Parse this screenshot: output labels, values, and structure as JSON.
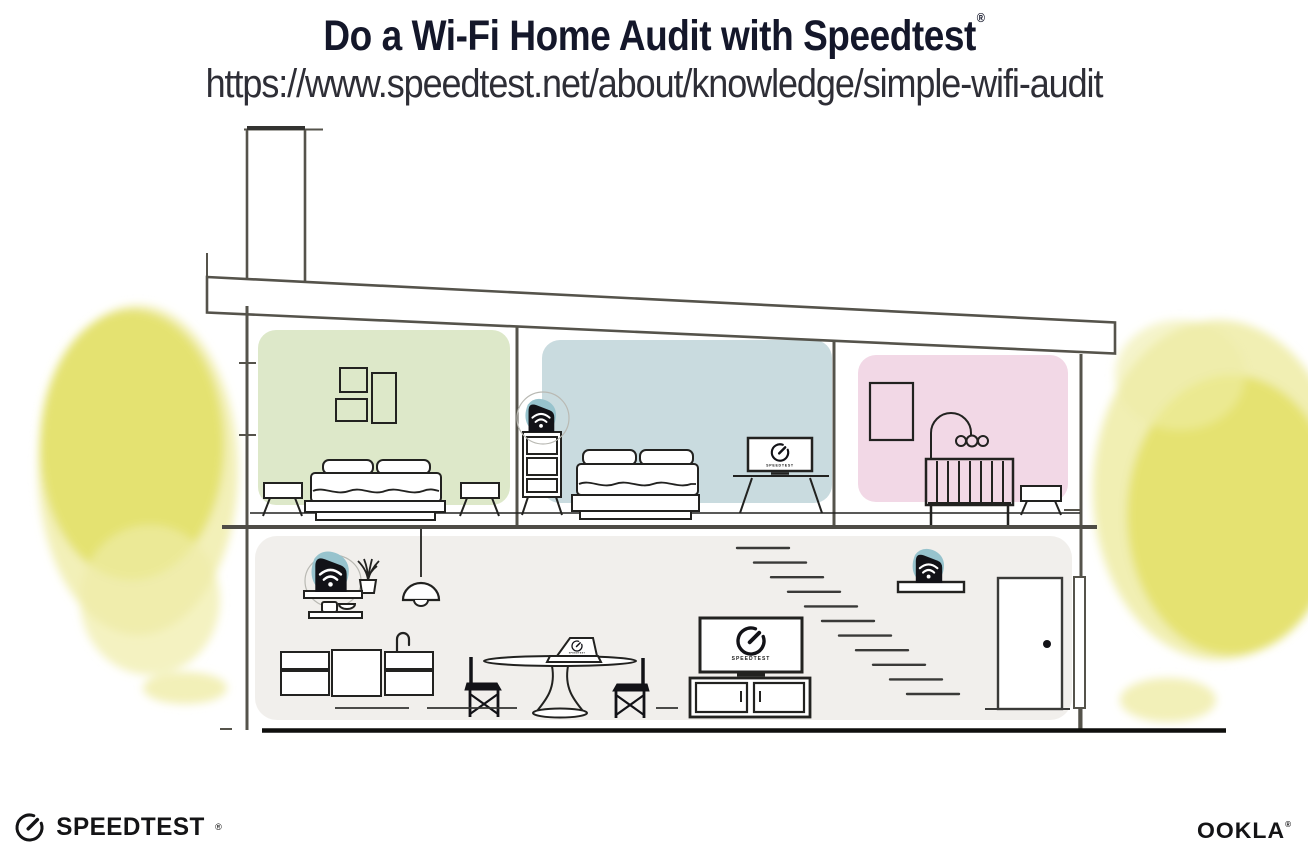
{
  "header": {
    "title": "Do a Wi-Fi Home Audit with Speedtest",
    "registered_mark": "®",
    "url": "https://www.speedtest.net/about/knowledge/simple-wifi-audit"
  },
  "illustration": {
    "screen_label": "SPEEDTEST",
    "wifi_node_count": 3,
    "icons": {
      "wifi_node": "wifi-signal-on-black-router",
      "speedtest_gauge": "gauge-with-needle"
    }
  },
  "footer": {
    "speedtest_logo_text": "SPEEDTEST",
    "speedtest_registered_mark": "®",
    "ookla_logo_text": "OOKLA",
    "ookla_registered_mark": "®"
  },
  "colors": {
    "title_text": "#14172a",
    "url_text": "#2e2e36",
    "room_green": "#dde8c9",
    "room_blue": "#c9dbdf",
    "room_pink": "#f2d8e6",
    "lower_floor": "#f1efec",
    "tree_yellow": "#e4e16e",
    "tree_yellow_light": "#efeca6",
    "node_teal": "#97c3cd",
    "device_black": "#121217",
    "line_black": "#222220",
    "line_structure": "#55534b",
    "stair_gray": "#3a3a38",
    "logo_black": "#141416"
  }
}
